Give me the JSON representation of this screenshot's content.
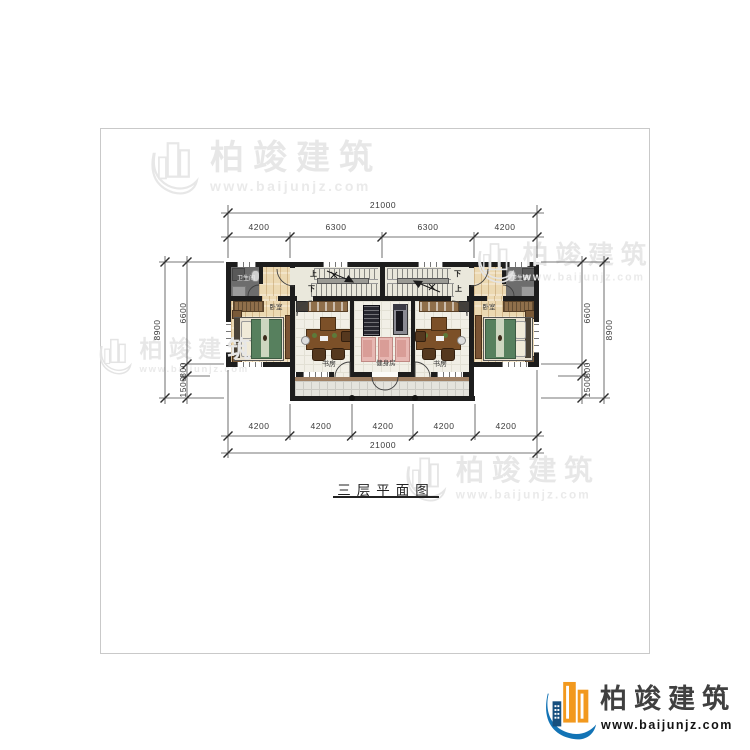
{
  "page": {
    "title_text": "三层平面图"
  },
  "brand": {
    "name": "柏竣建筑",
    "site": "www.baijunjz.com"
  },
  "dims": {
    "top": {
      "total": "21000",
      "segments": [
        "4200",
        "6300",
        "6300",
        "4200"
      ]
    },
    "bottom": {
      "total": "21000",
      "segments": [
        "4200",
        "4200",
        "4200",
        "4200",
        "4200"
      ]
    },
    "left": {
      "total": "8900",
      "parts": [
        "6600",
        "800",
        "1500"
      ]
    },
    "right": {
      "total": "8900",
      "parts": [
        "6600",
        "800",
        "1500"
      ]
    }
  },
  "rooms": {
    "bathroom": "卫生间",
    "bedroom": "卧室",
    "study": "书房",
    "gym": "健身房",
    "stairs": {
      "up": "上",
      "down": "下"
    }
  },
  "icons": {
    "watermark_logo": "building-outline-icon",
    "brand_logo": "building-swoosh-icon"
  },
  "colors": {
    "wall": "#1d1d1d",
    "wood_floor": "#ecd9b2",
    "bathroom_floor": "#6d6d6d",
    "bed_green": "#57805e",
    "mat_pink": "#e7b7b2",
    "terrace_band": "#a08165",
    "brand_blue": "#1273b5",
    "brand_orange": "#f2991e",
    "watermark_gray": "#e7e7e7"
  }
}
